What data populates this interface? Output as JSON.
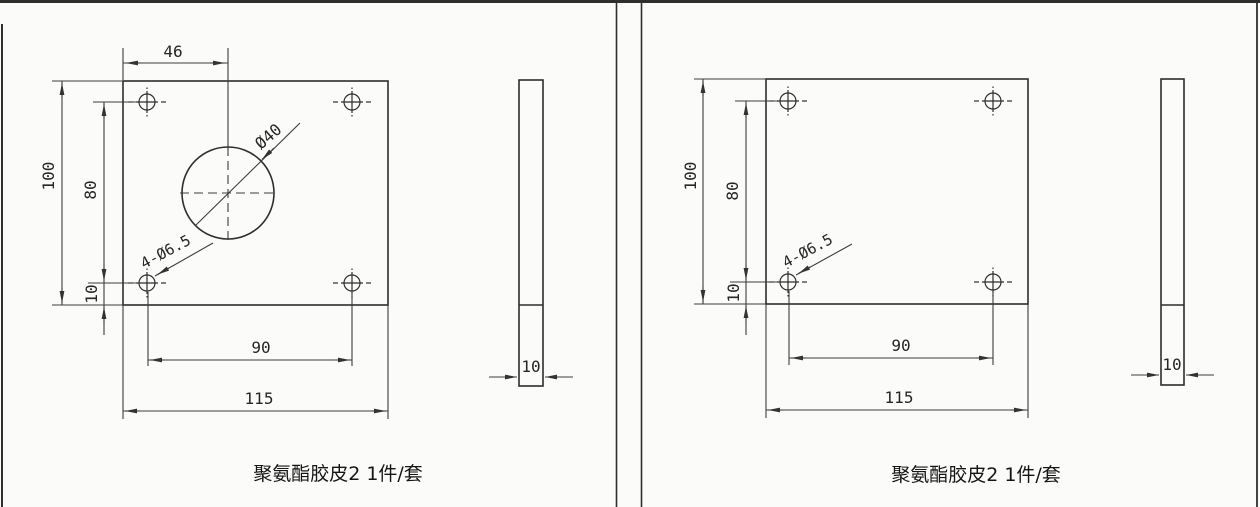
{
  "document_type": "engineering-drawing",
  "colors": {
    "ink": "#333333",
    "background": "#fbfbf9"
  },
  "panels": [
    {
      "caption": "聚氨酯胶皮2 1件/套",
      "front_view": {
        "dims": {
          "width_top": "46",
          "height": "100",
          "hole_span_v": "80",
          "edge_offset": "10",
          "hole_span_h": "90",
          "width": "115"
        },
        "labels": {
          "center_hole_dia": "Ø40",
          "corner_holes": "4-Ø6.5"
        }
      },
      "side_view": {
        "thickness": "10"
      }
    },
    {
      "caption": "聚氨酯胶皮2 1件/套",
      "front_view": {
        "dims": {
          "height": "100",
          "hole_span_v": "80",
          "edge_offset": "10",
          "hole_span_h": "90",
          "width": "115"
        },
        "labels": {
          "corner_holes": "4-Ø6.5"
        }
      },
      "side_view": {
        "thickness": "10"
      }
    }
  ]
}
